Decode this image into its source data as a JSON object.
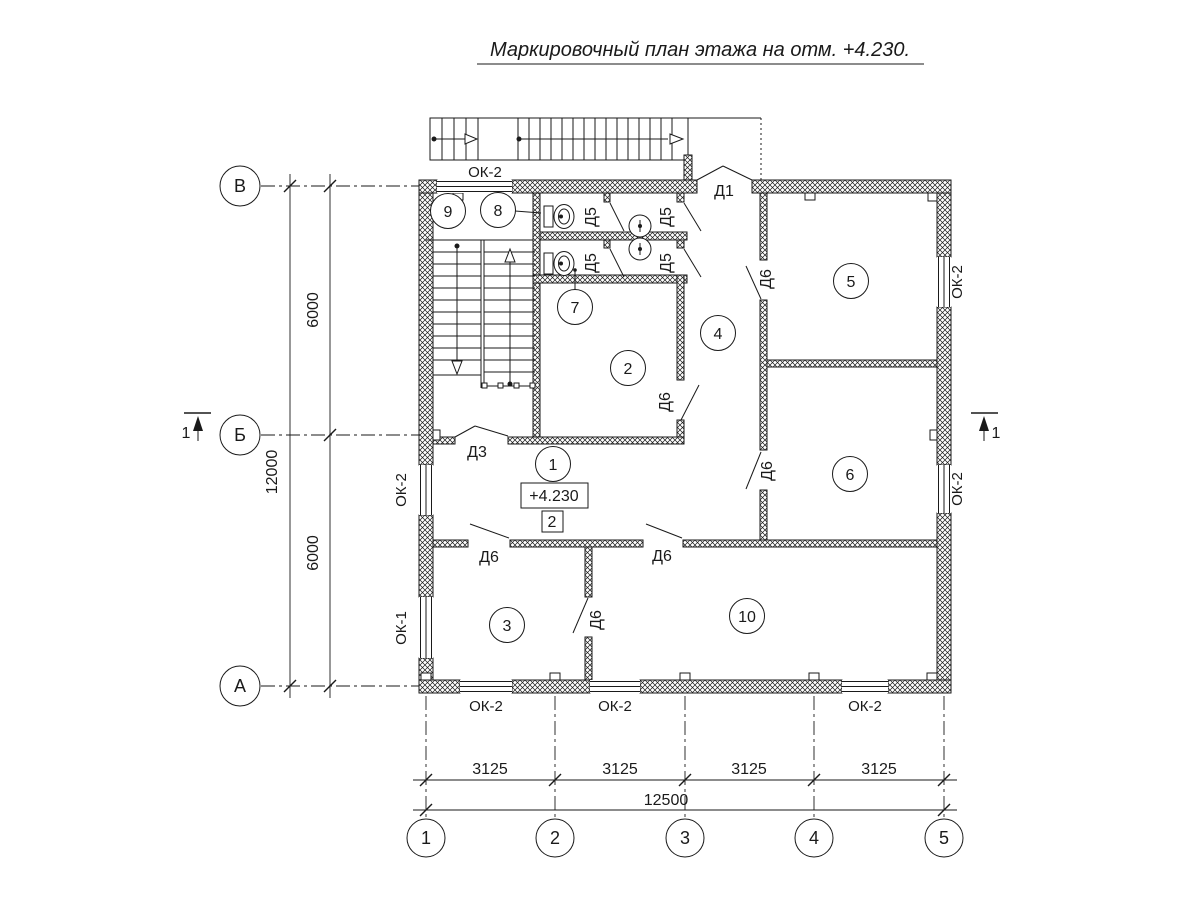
{
  "title": "Маркировочный план этажа на отм. +4.230.",
  "level_mark": "+4.230",
  "zone_mark": "2",
  "section_mark": "1",
  "row_axes": [
    {
      "label": "В"
    },
    {
      "label": "Б"
    },
    {
      "label": "А"
    }
  ],
  "col_axes": [
    {
      "label": "1"
    },
    {
      "label": "2"
    },
    {
      "label": "3"
    },
    {
      "label": "4"
    },
    {
      "label": "5"
    }
  ],
  "dimensions": {
    "vertical_total": "12000",
    "vertical_upper": "6000",
    "vertical_lower": "6000",
    "horizontal_segments": [
      "3125",
      "3125",
      "3125",
      "3125"
    ],
    "horizontal_total": "12500"
  },
  "rooms": [
    {
      "number": "1"
    },
    {
      "number": "2"
    },
    {
      "number": "3"
    },
    {
      "number": "4"
    },
    {
      "number": "5"
    },
    {
      "number": "6"
    },
    {
      "number": "7"
    },
    {
      "number": "8"
    },
    {
      "number": "9"
    },
    {
      "number": "10"
    }
  ],
  "door_marks": {
    "d1": "Д1",
    "d3": "Д3",
    "d5": "Д5",
    "d6": "Д6"
  },
  "window_marks": {
    "ok1": "ОК-1",
    "ok2": "ОК-2"
  },
  "colors": {
    "ink": "#1a1a1a",
    "paper": "#ffffff"
  }
}
